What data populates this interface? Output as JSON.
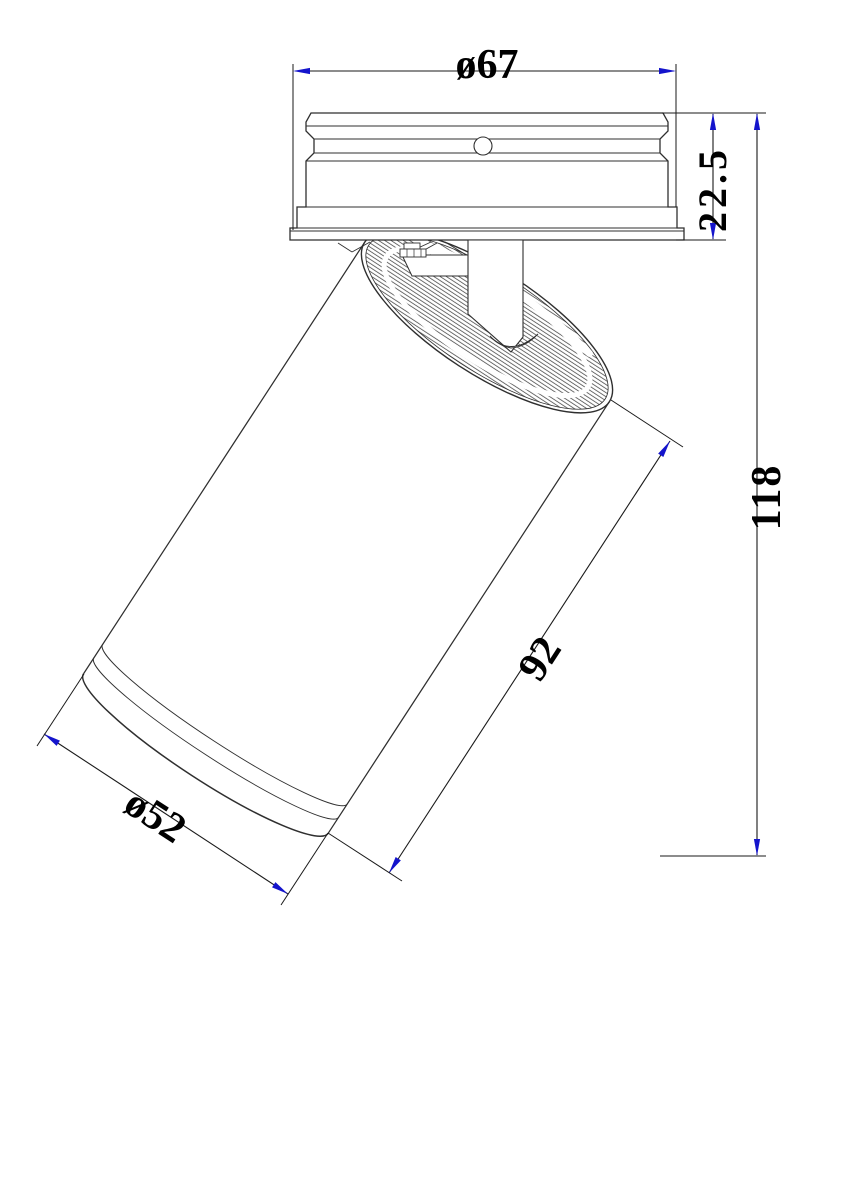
{
  "drawing": {
    "description": "Technical dimension drawing of an adjustable surface-mounted spotlight: mounting canopy side view with tilted cylindrical lamp head",
    "dimensions": {
      "canopy_diameter": "ø67",
      "canopy_height": "22.5",
      "overall_height": "118",
      "head_length": "92",
      "head_diameter": "ø52"
    },
    "colors": {
      "line": "#2f2f2f",
      "dimension_line": "#1a1a1a",
      "arrow_blue": "#1414cc",
      "text": "#000000",
      "background": "#ffffff"
    }
  }
}
